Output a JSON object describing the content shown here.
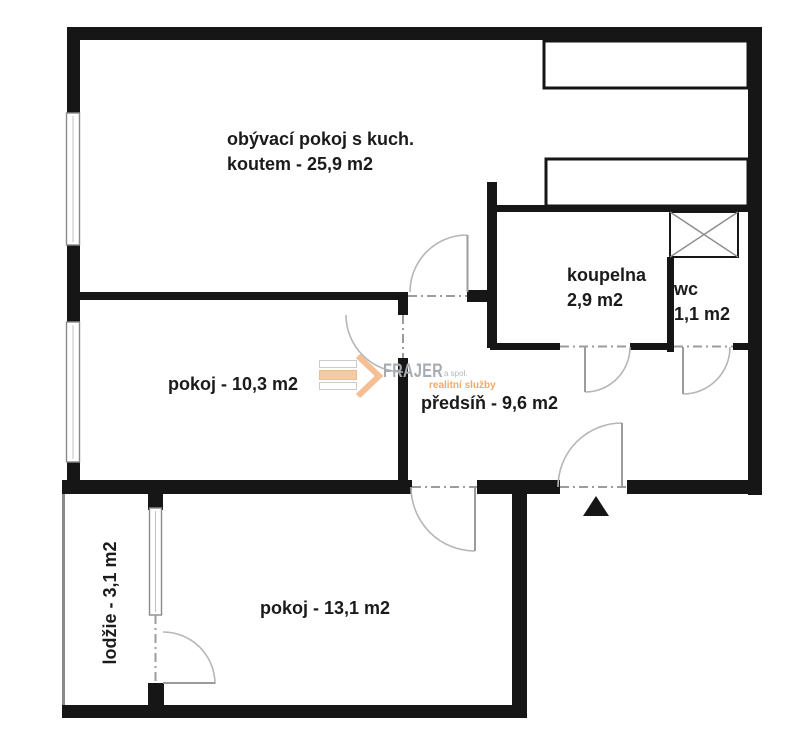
{
  "title": "apartment floor plan",
  "rooms": {
    "living": {
      "line1": "obývací pokoj s kuch.",
      "line2": "koutem - 25,9 m2"
    },
    "bathroom": {
      "line1": "koupelna",
      "line2": "2,9 m2"
    },
    "wc": {
      "line1": "wc",
      "line2": "1,1 m2"
    },
    "room_small": {
      "line1": "pokoj - 10,3 m2"
    },
    "hall": {
      "line1": "předsíň - 9,6 m2"
    },
    "room_large": {
      "line1": "pokoj - 13,1 m2"
    },
    "loggia": {
      "line1": "lodžie - 3,1 m2"
    }
  },
  "watermark": {
    "brand": "FRAJER",
    "brand_suffix": "a spol.",
    "tagline": "realitní služby"
  },
  "colors": {
    "wall": "#161616",
    "door_arc": "#b6b6b6",
    "opening_dash": "#9c9c9c",
    "label_text": "#1b1b1b",
    "brand_gray": "#a6acb1",
    "accent_orange": "#f2a869",
    "logo_bar_fill": "#f5cba4"
  }
}
